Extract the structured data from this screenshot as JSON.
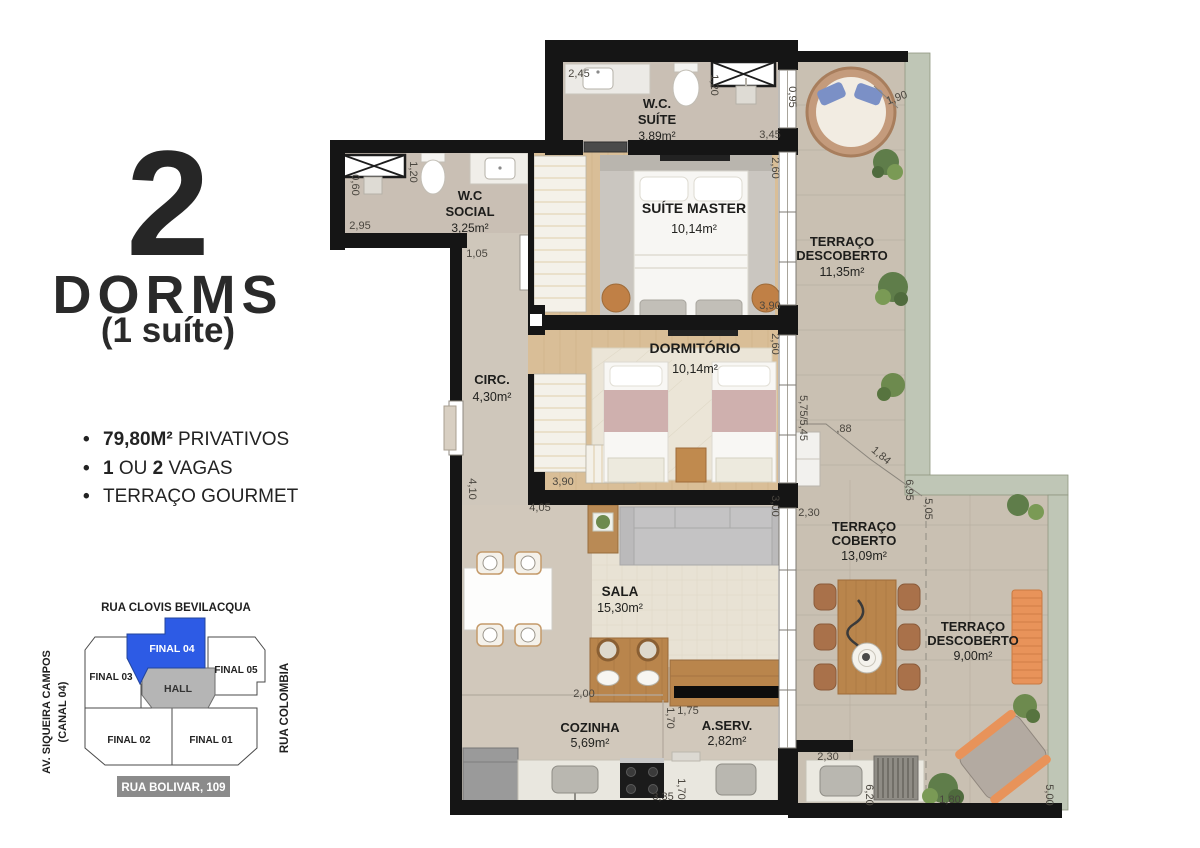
{
  "panel": {
    "big_number": "2",
    "title": "DORMS",
    "subtitle": "(1 suíte)",
    "features": {
      "bullet": "•",
      "f1_bold": "79,80M²",
      "f1_rest": " PRIVATIVOS",
      "f2_b1": "1",
      "f2_r1": " OU ",
      "f2_b2": "2",
      "f2_r2": " VAGAS",
      "f3": "TERRAÇO GOURMET"
    }
  },
  "site_plan": {
    "street_top": "RUA CLOVIS BEVILACQUA",
    "street_left_line1": "AV. SIQUEIRA CAMPOS",
    "street_left_line2": "(CANAL 04)",
    "street_right": "RUA COLOMBIA",
    "address_badge": "RUA BOLIVAR, 109",
    "highlight_color": "#2d5be5",
    "units": {
      "final03": "FINAL 03",
      "final04": "FINAL 04",
      "final05": "FINAL 05",
      "hall": "HALL",
      "final02": "FINAL 02",
      "final01": "FINAL 01"
    }
  },
  "plan": {
    "rooms": {
      "wc_suite": {
        "l1": "W.C.",
        "l2": "SUÍTE",
        "area": "3,89m²"
      },
      "wc_social": {
        "l1": "W.C",
        "l2": "SOCIAL",
        "area": "3,25m²"
      },
      "suite_master": {
        "l1": "SUÍTE MASTER",
        "area": "10,14m²"
      },
      "dormitorio": {
        "l1": "DORMITÓRIO",
        "area": "10,14m²"
      },
      "terraco_descoberto_1": {
        "l1": "TERRAÇO",
        "l2": "DESCOBERTO",
        "area": "11,35m²"
      },
      "circ": {
        "l1": "CIRC.",
        "area": "4,30m²"
      },
      "sala": {
        "l1": "SALA",
        "area": "15,30m²"
      },
      "terraco_coberto": {
        "l1": "TERRAÇO",
        "l2": "COBERTO",
        "area": "13,09m²"
      },
      "terraco_descoberto_2": {
        "l1": "TERRAÇO",
        "l2": "DESCOBERTO",
        "area": "9,00m²"
      },
      "cozinha": {
        "l1": "COZINHA",
        "area": "5,69m²"
      },
      "aserv": {
        "l1": "A.SERV.",
        "area": "2,82m²"
      }
    },
    "dims": [
      "2,45",
      "1,20",
      "0,95",
      "3,45",
      "1,20",
      "0,60",
      "2,95",
      "1,05",
      "1,90",
      "2,60",
      "3,90",
      "2,60",
      "5,75/5,45",
      "3,90",
      "4,10",
      "4,05",
      ",88",
      "1,84",
      "6,95",
      "5,05",
      "2,30",
      "3,00",
      "2,00",
      "1,70",
      "1,75",
      "3,35",
      "1,70",
      "2,30",
      "6,20",
      "1,80",
      "5,00"
    ],
    "colors": {
      "wall": "#151515",
      "wood_floor": "#d9be97",
      "bath_floor": "#c9bfb4",
      "living_floor": "#d1c8bb",
      "terrace_floor": "#c9c0b2",
      "parapet_concrete": "#bfc6b6",
      "wood_furniture": "#b9854c",
      "orange_furniture": "#e8935a",
      "bed_pink": "#cfb0ae",
      "pillow_blue": "#7b90c6"
    }
  }
}
